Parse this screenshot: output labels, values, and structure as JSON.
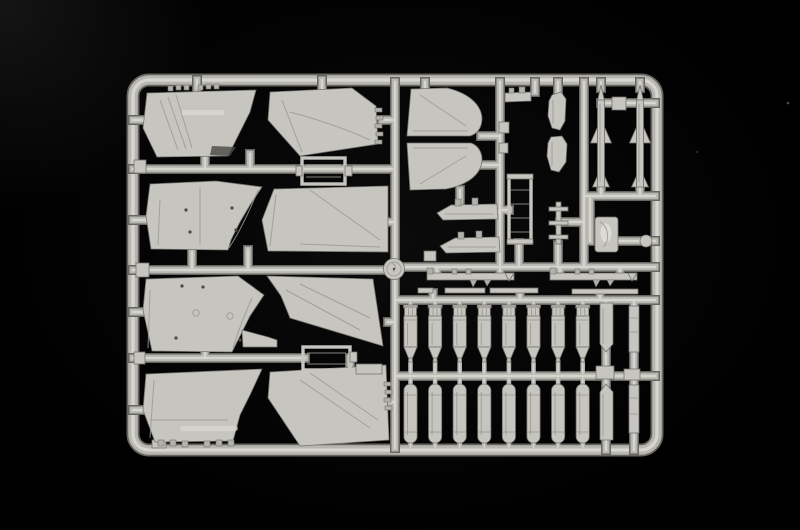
{
  "meta": {
    "type": "photograph",
    "description": "Light grey injection-moulded plastic model kit sprue (parts tree) photographed on a black background. The rectangular frame holds aircraft wing panels, vertical tail fin halves, two air-to-air missile halves, rows of bomb and fuel-tank halves, pylons, missile rails, a boarding ladder and other small airframe parts."
  },
  "colors": {
    "background": "#000000",
    "plastic": "#c6c5bf",
    "plastic_light": "#dbdad4",
    "plastic_mid": "#b2b1ab",
    "plastic_edge": "#74736d",
    "run_core": "#d6d5cf",
    "run_body": "#b7b6b0",
    "run_edge": "#66655f",
    "detail_line": "#9a9993",
    "hole_dark": "#4a4945"
  },
  "sprue": {
    "frame": {
      "x": 133,
      "y": 80,
      "width": 524,
      "height": 370,
      "radius": 16
    },
    "counts": {
      "wing_panels": 8,
      "tail_fin_halves": 2,
      "stabilator_parts": 2,
      "missile_halves": 2,
      "bomb_halves_upper_row": 8,
      "tank_halves_lower_row": 8,
      "missile_rails": 2,
      "drop_tank_halves": 2,
      "pylon_strips": 4,
      "rect_frame_parts": 2,
      "round_dish_parts": 1
    },
    "missiles": {
      "x_positions": [
        601,
        640
      ],
      "tip_y": 85,
      "tail_y": 187
    },
    "bomb_row_upper": {
      "count": 8,
      "x_start": 410.5,
      "spacing": 24.6,
      "top_y": 305,
      "tip_y": 360
    },
    "tank_row_lower": {
      "count": 8,
      "x_start": 410.5,
      "spacing": 24.6,
      "top_y": 384,
      "bottom_y": 443
    }
  }
}
